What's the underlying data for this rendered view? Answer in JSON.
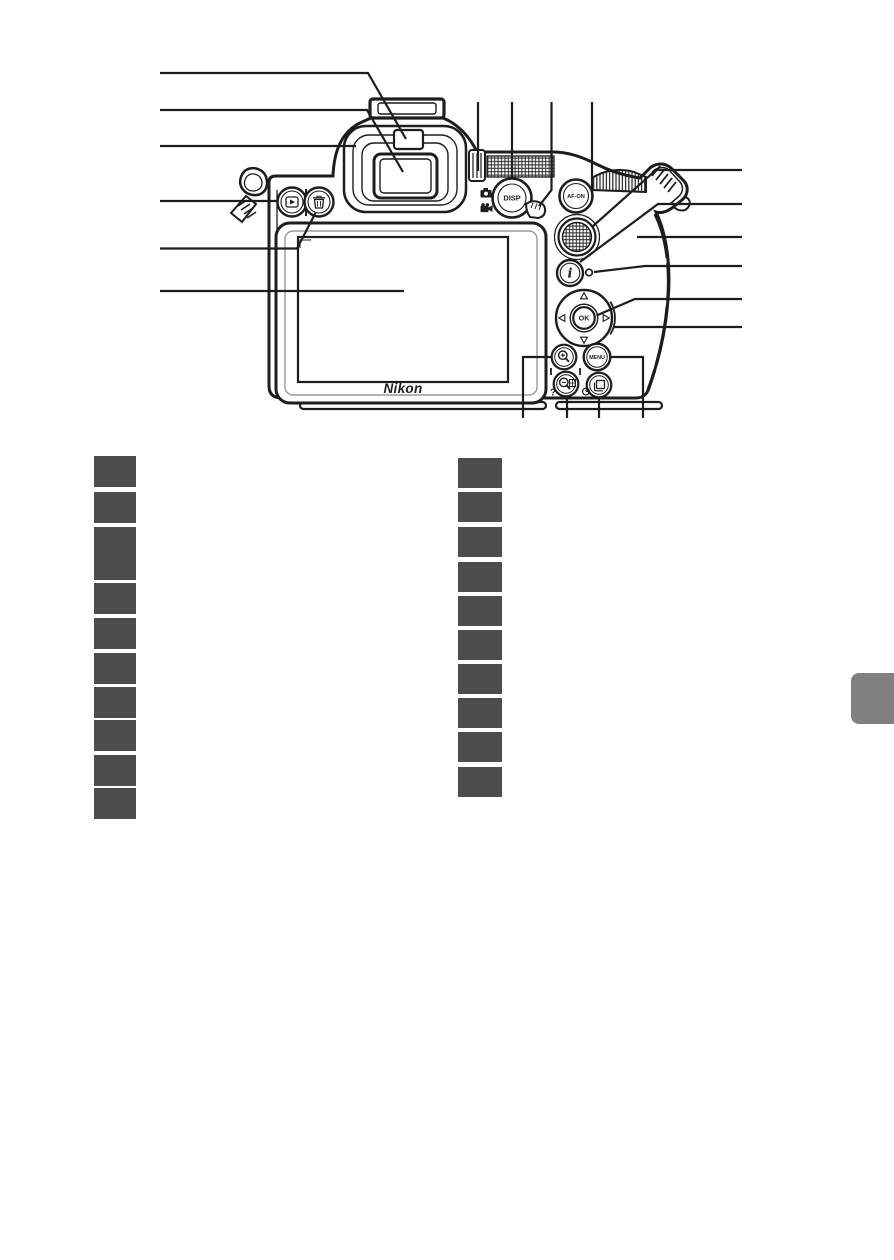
{
  "page": {
    "background": "#ffffff"
  },
  "diagram": {
    "name": "camera-back-parts-diagram",
    "line_color": "#1d1d1d",
    "labels": {
      "disp": "DISP",
      "af_on": "AF-ON",
      "i_button": "i",
      "ok": "OK",
      "menu": "MENU",
      "help": "?",
      "brand": "Nikon"
    },
    "icons": [
      "hot-shoe-icon",
      "eye-sensor-icon",
      "viewfinder-eyepiece-icon",
      "rubber-eyecup-icon",
      "playback-icon",
      "trash-icon",
      "monitor-screen",
      "diopter-adjustment-icon",
      "photo-mode-icon",
      "movie-mode-icon",
      "photo-movie-selector-icon",
      "main-command-dial-icon",
      "sub-selector-joystick-icon",
      "speaker-dot-icon",
      "multi-selector-icon",
      "zoom-in-icon",
      "zoom-out-grid-icon",
      "question-mark",
      "self-timer-icon",
      "release-mode-icon",
      "strap-eyelet-icon"
    ]
  },
  "legend": {
    "box_color": "#4d4d4d",
    "left": [
      {
        "label": "",
        "tall": false
      },
      {
        "label": "",
        "tall": false
      },
      {
        "label": "",
        "tall": true
      },
      {
        "label": "",
        "tall": false
      },
      {
        "label": "",
        "tall": false
      },
      {
        "label": "",
        "tall": false
      },
      {
        "label": "",
        "tall": false
      },
      {
        "label": "",
        "tall": false
      },
      {
        "label": "",
        "tall": false
      },
      {
        "label": "",
        "tall": false
      }
    ],
    "right": [
      {
        "label": "",
        "tall": false
      },
      {
        "label": "",
        "tall": false
      },
      {
        "label": "",
        "tall": false
      },
      {
        "label": "",
        "tall": false
      },
      {
        "label": "",
        "tall": false
      },
      {
        "label": "",
        "tall": false
      },
      {
        "label": "",
        "tall": false
      },
      {
        "label": "",
        "tall": false
      },
      {
        "label": "",
        "tall": false
      },
      {
        "label": "",
        "tall": false
      }
    ]
  },
  "side_tab": {
    "color": "#808080"
  }
}
